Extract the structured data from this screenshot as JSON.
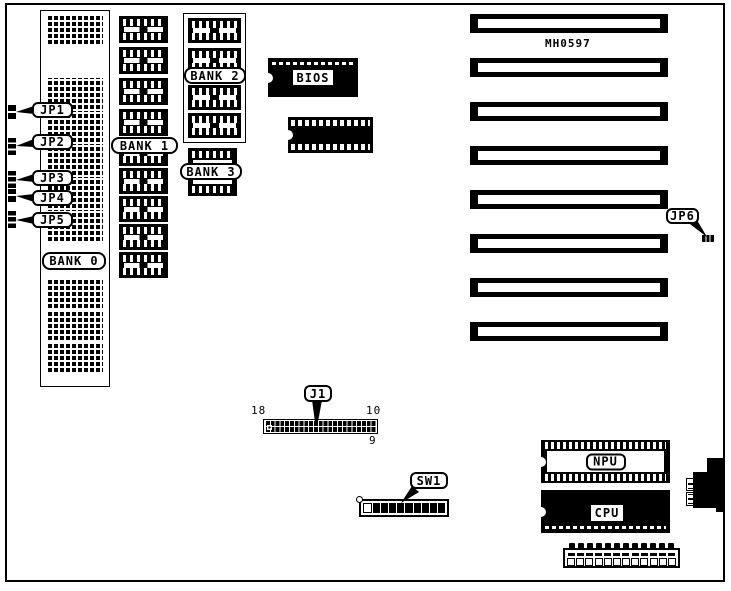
{
  "diagram": {
    "board_id": "MH0597",
    "labels": {
      "jp1": "JP1",
      "jp2": "JP2",
      "jp3": "JP3",
      "jp4": "JP4",
      "jp5": "JP5",
      "jp6": "JP6",
      "bank0": "BANK 0",
      "bank1": "BANK 1",
      "bank2": "BANK 2",
      "bank3": "BANK 3",
      "bios": "BIOS",
      "npu": "NPU",
      "cpu": "CPU",
      "j1": "J1",
      "sw1": "SW1"
    },
    "j1_pin_numbers": {
      "left": "18",
      "right_top": "10",
      "right_bottom": "9"
    }
  }
}
